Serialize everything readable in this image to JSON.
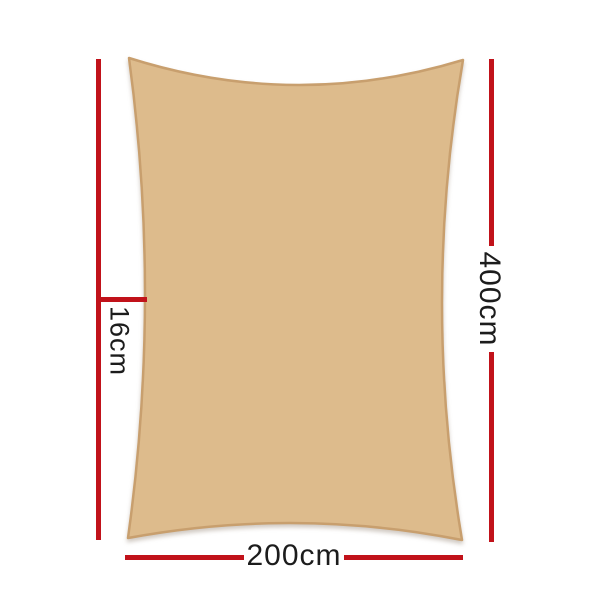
{
  "diagram": {
    "labels": {
      "left_vertical": "16cm",
      "right_vertical": "400cm",
      "bottom_horizontal": "200cm"
    },
    "colors": {
      "sail_fill": "#ddbb8c",
      "sail_edge": "#c89f6e",
      "dimension_line": "#c1121a",
      "text": "#1c1c1c",
      "background": "#ffffff"
    }
  }
}
